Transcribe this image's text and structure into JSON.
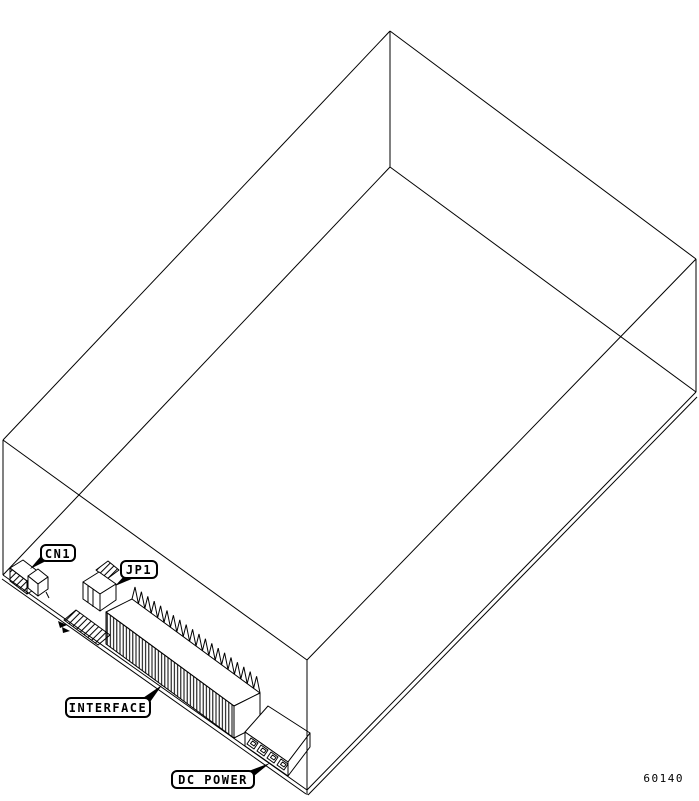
{
  "figure": {
    "type": "isometric-technical-drawing",
    "subject": "disk drive enclosure with bottom PCB connectors",
    "background_color": "#ffffff",
    "line_color": "#000000",
    "number": "60140",
    "callouts": {
      "cn1": "CN1",
      "jp1": "JP1",
      "interface": "INTERFACE",
      "dc_power": "DC POWER"
    }
  }
}
